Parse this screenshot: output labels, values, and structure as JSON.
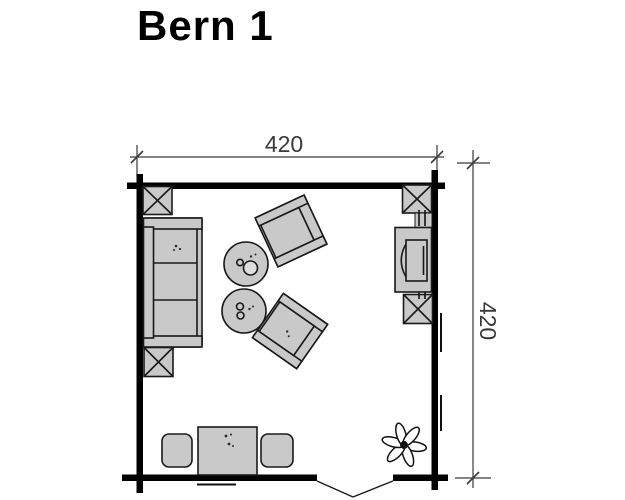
{
  "title": "Bern 1",
  "dimensions": {
    "width_label": "420",
    "depth_label": "420"
  },
  "furniture": {
    "items": [
      "sofa",
      "round-coffee-table",
      "round-coffee-table",
      "armchair",
      "armchair",
      "tv-sideboard",
      "desk-table",
      "desk-chair",
      "desk-chair",
      "plant"
    ]
  },
  "structure": {
    "corner_log_joints": 4,
    "window_markers": 2,
    "door": "double-swing-bottom"
  },
  "colors": {
    "background": "#ffffff",
    "wall": "#000000",
    "furniture_fill": "#c9c9c9",
    "outline": "#1a1a1a",
    "dimension_line": "#3a3a3a"
  }
}
